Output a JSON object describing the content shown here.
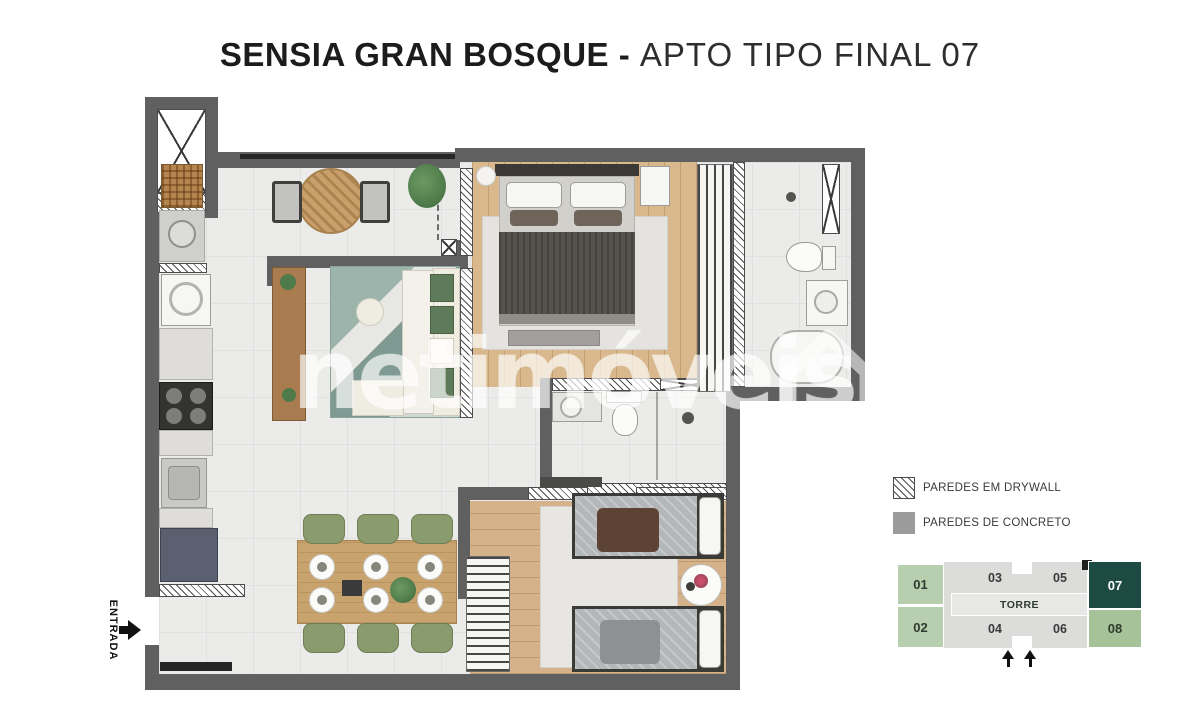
{
  "title": {
    "project_bold": "SENSIA GRAN BOSQUE -",
    "unit_light": "APTO TIPO FINAL 07"
  },
  "watermark": {
    "brand": "netimóveis"
  },
  "entrance": {
    "label": "ENTRADA"
  },
  "legend": {
    "drywall_label": "PAREDES EM DRYWALL",
    "concrete_label": "PAREDES DE CONCRETO"
  },
  "key_plan": {
    "tower_label": "TORRE",
    "units": [
      {
        "number": "01"
      },
      {
        "number": "02"
      },
      {
        "number": "03"
      },
      {
        "number": "04"
      },
      {
        "number": "05"
      },
      {
        "number": "06"
      },
      {
        "number": "07",
        "highlighted": true
      },
      {
        "number": "08"
      }
    ]
  },
  "colors": {
    "wall_concrete": "#606060",
    "legend_concrete_swatch": "#9b9b9b",
    "wood_floor": "#d8b88c",
    "tile_floor": "#ebecea",
    "dining_chair_green": "#8a9b6d",
    "rug_teal": "#8aa49c",
    "key_plan_light_green": "#b7cfae",
    "key_plan_green": "#a6c298",
    "key_plan_gray": "#dcdcdb",
    "key_plan_highlight": "#1d4a43"
  }
}
